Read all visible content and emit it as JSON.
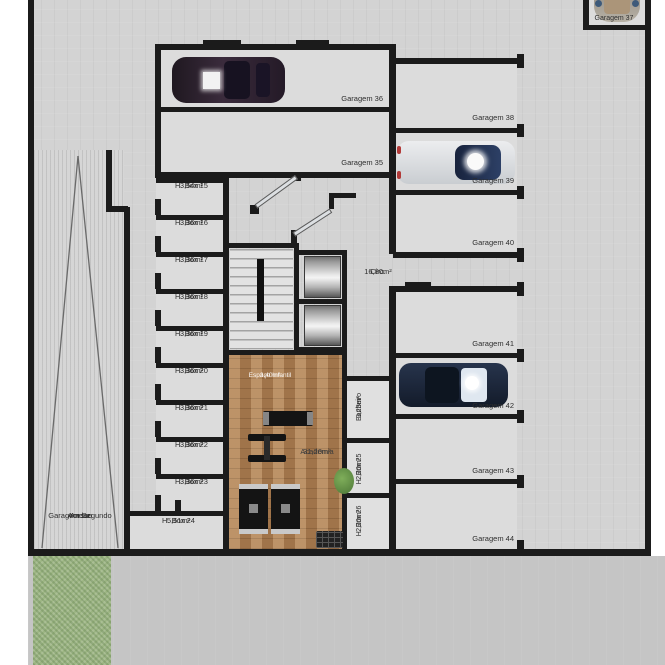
{
  "plan_title": "Pavimento Garagem - Planta Baixa",
  "colors": {
    "wall": "#1b1b1b",
    "concrete": "#d3d3d3",
    "street": "#c5c5c5",
    "grass": "#9cb583",
    "wood_floor": "#b08255",
    "window_teal": "#3f93a3",
    "mat_orange": "#c06030",
    "mat_teal": "#9fccc4",
    "elevator_metal": "#b3b3b3"
  },
  "garages": [
    {
      "label": "Garagem 35",
      "occupied": false
    },
    {
      "label": "Garagem 36",
      "occupied": true
    },
    {
      "label": "Garagem 37",
      "occupied": true
    },
    {
      "label": "Garagem 38",
      "occupied": false
    },
    {
      "label": "Garagem 39",
      "occupied": true
    },
    {
      "label": "Garagem 40",
      "occupied": false
    },
    {
      "label": "Garagem 41",
      "occupied": false
    },
    {
      "label": "Garagem 42",
      "occupied": true
    },
    {
      "label": "Garagem 43",
      "occupied": false
    },
    {
      "label": "Garagem 44",
      "occupied": false
    }
  ],
  "hboxes": [
    {
      "name": "H. Box 15",
      "area": "3,54m²"
    },
    {
      "name": "H. Box 16",
      "area": "3,36m²"
    },
    {
      "name": "H. Box 17",
      "area": "3,36m²"
    },
    {
      "name": "H. Box 18",
      "area": "3,36m²"
    },
    {
      "name": "H. Box 19",
      "area": "3,36m²"
    },
    {
      "name": "H. Box 20",
      "area": "3,36m²"
    },
    {
      "name": "H. Box 21",
      "area": "3,36m²"
    },
    {
      "name": "H. Box 22",
      "area": "3,36m²"
    },
    {
      "name": "H. Box 23",
      "area": "3,36m²"
    },
    {
      "name": "H. Box 24",
      "area": "5,51m²"
    },
    {
      "name": "H. Box 25",
      "area": "2,20m²"
    },
    {
      "name": "H. Box 26",
      "area": "2,20m²"
    }
  ],
  "rooms": {
    "circulation": {
      "name": "Circ.",
      "area": "16,80m²"
    },
    "gym": {
      "name": "Academia",
      "area": "31,20m²"
    },
    "kids_space": {
      "name": "Espaço Infantil",
      "area": "3,40m²"
    },
    "bathroom": {
      "name": "Banheiro",
      "area": "3,23m²"
    },
    "ramp": {
      "line1": "Acesso",
      "line2": "Garagem Segundo",
      "line3": "Andar"
    }
  }
}
